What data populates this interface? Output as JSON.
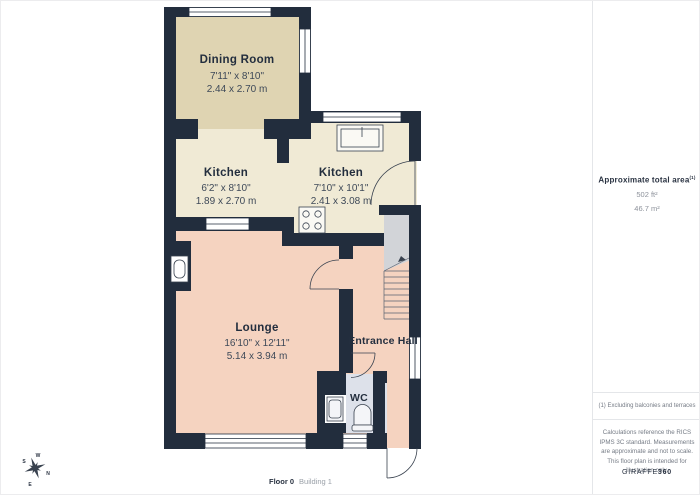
{
  "floor_plan": {
    "rooms": [
      {
        "name": "Dining Room",
        "dims_imperial": "7'11\" x 8'10\"",
        "dims_metric": "2.44 x 2.70 m"
      },
      {
        "name": "Kitchen",
        "dims_imperial": "6'2\" x 8'10\"",
        "dims_metric": "1.89 x 2.70 m"
      },
      {
        "name": "Kitchen",
        "dims_imperial": "7'10\" x 10'1\"",
        "dims_metric": "2.41 x 3.08 m"
      },
      {
        "name": "Lounge",
        "dims_imperial": "16'10\" x 12'11\"",
        "dims_metric": "5.14 x 3.94 m"
      },
      {
        "name": "Entrance Hall"
      },
      {
        "name": "WC"
      }
    ],
    "compass": {
      "n": "N",
      "s": "S",
      "e": "E",
      "w": "W"
    },
    "icons": [
      "sink-icon",
      "hob-icon",
      "toilet-icon",
      "basin-icon",
      "fireplace-icon",
      "stairs",
      "compass-icon"
    ]
  },
  "info_panel": {
    "area_title": "Approximate total area",
    "area_title_sup": "(1)",
    "area_ft": "502 ft²",
    "area_m": "46.7 m²",
    "footnote": "(1) Excluding balconies and terraces",
    "disclaimer": "Calculations reference the RICS IPMS 3C standard. Measurements are approximate and not to scale. This floor plan is intended for illustration only.",
    "brand_name": "GIRAFFE",
    "brand_suffix": "360"
  },
  "footer": {
    "floor_label": "Floor 0",
    "building_label": "Building 1"
  },
  "colors": {
    "wall": "#222D3D",
    "dining_floor": "#DFD4B2",
    "kitchen_floor": "#F0EAD5",
    "lounge_floor": "#F5D3C0",
    "wc_floor": "#DDE1EA",
    "stairs": "#D2D4D8"
  }
}
